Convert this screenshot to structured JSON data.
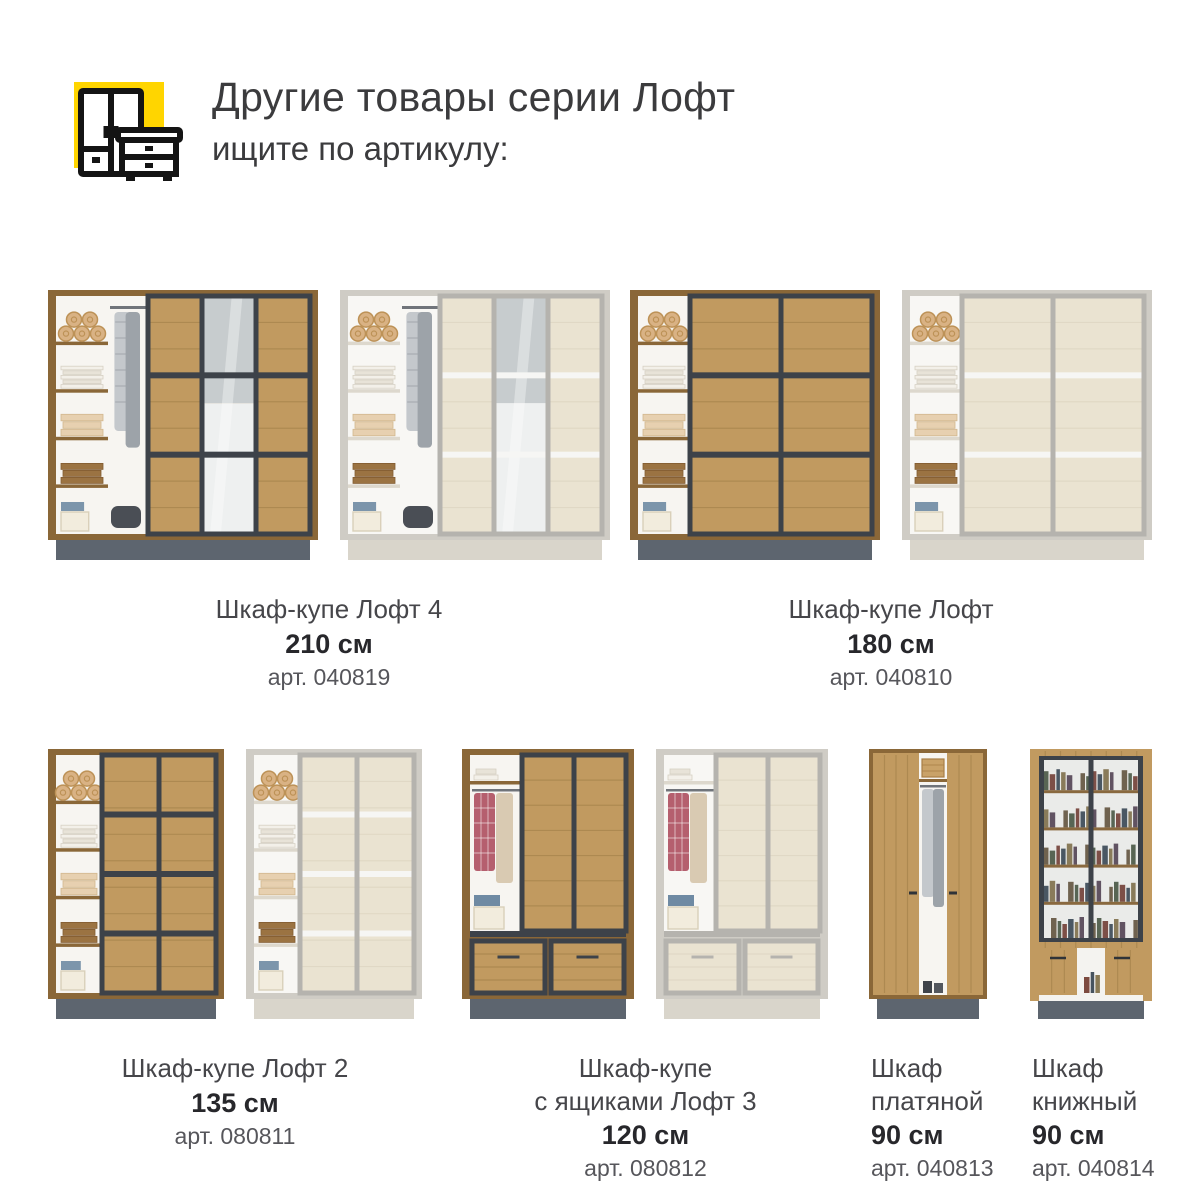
{
  "header": {
    "title": "Другие товары серии Лофт",
    "subtitle": "ищите по артикулу:",
    "icon": {
      "name": "wardrobe-and-nightstand-icon",
      "bg_color": "#FFD500",
      "line_color": "#141414"
    }
  },
  "colors": {
    "page_bg": "#ffffff",
    "title_text": "#3b3b3d",
    "name_text": "#46464a",
    "size_text": "#27272b",
    "article_text": "#56565b",
    "palettes": {
      "dark": {
        "side": "#8a6738",
        "wood": "#c19a60",
        "grain": "#9b7a44",
        "frame": "#3d4249",
        "divider": "#3d4249",
        "plinth": "#5d656f",
        "shelf": "#8a6738",
        "interior": "#f7f5f1"
      },
      "light": {
        "side": "#cfccc5",
        "wood": "#eae3d1",
        "grain": "#d8cfba",
        "frame": "#b5b3ae",
        "divider": "#f6f6f4",
        "plinth": "#d9d5cb",
        "shelf": "#ddd8cd",
        "interior": "#f8f7f4"
      }
    },
    "items": {
      "rolls": "#d9b284",
      "rolls_stroke": "#bd9257",
      "white_a": "#f3f0e9",
      "white_b": "#e8e3d8",
      "white_stroke": "#d6d0c4",
      "beige": "#e7d0b0",
      "beige_stroke": "#d2b78e",
      "brown": "#9b7342",
      "brown_stroke": "#825c31",
      "blue": "#7c95ab",
      "box": "#f2ecdd",
      "box_stroke": "#d9d0ba",
      "garment_a": "#c4c8cc",
      "garment_b": "#9da3a9",
      "bag": "#4a4e55",
      "plaid": "#b55f6e",
      "second_garment": "#d9cab2",
      "jeans": "#6f8aa3",
      "basket": "#c9a268",
      "mirror_top": "#c7ccce",
      "mirror_bottom": "#eef0f0",
      "book_colors": [
        "#6e5f49",
        "#55624f",
        "#7d4a40",
        "#46535f",
        "#8a7a55",
        "#5f4f5e",
        "#77674f"
      ]
    }
  },
  "products": [
    {
      "id": "loft4",
      "row": 1,
      "name_lines": [
        "Шкаф-купе Лофт 4"
      ],
      "size": "210 см",
      "article": "арт. 040819",
      "variants": [
        "dark",
        "light"
      ],
      "image_type": "sliding-3door-mirror",
      "label_align": "center"
    },
    {
      "id": "loft180",
      "row": 1,
      "name_lines": [
        "Шкаф-купе Лофт"
      ],
      "size": "180 см",
      "article": "арт. 040810",
      "variants": [
        "dark",
        "light"
      ],
      "image_type": "sliding-2door",
      "label_align": "center"
    },
    {
      "id": "loft2",
      "row": 2,
      "name_lines": [
        "Шкаф-купе Лофт 2"
      ],
      "size": "135 см",
      "article": "арт. 080811",
      "variants": [
        "dark",
        "light"
      ],
      "image_type": "sliding-2door-narrow",
      "label_align": "center"
    },
    {
      "id": "loft3",
      "row": 2,
      "name_lines": [
        "Шкаф-купе",
        "с ящиками Лофт 3"
      ],
      "size": "120 см",
      "article": "арт. 080812",
      "variants": [
        "dark",
        "light"
      ],
      "image_type": "sliding-drawers",
      "label_align": "center"
    },
    {
      "id": "plat",
      "row": 2,
      "name_lines": [
        "Шкаф",
        "платяной"
      ],
      "size": "90 см",
      "article": "арт. 040813",
      "variants": [
        "dark"
      ],
      "image_type": "hinged-2door",
      "label_align": "left"
    },
    {
      "id": "book",
      "row": 2,
      "name_lines": [
        "Шкаф",
        "книжный"
      ],
      "size": "90 см",
      "article": "арт. 040814",
      "variants": [
        "dark"
      ],
      "image_type": "bookcase-glass",
      "label_align": "left"
    }
  ]
}
